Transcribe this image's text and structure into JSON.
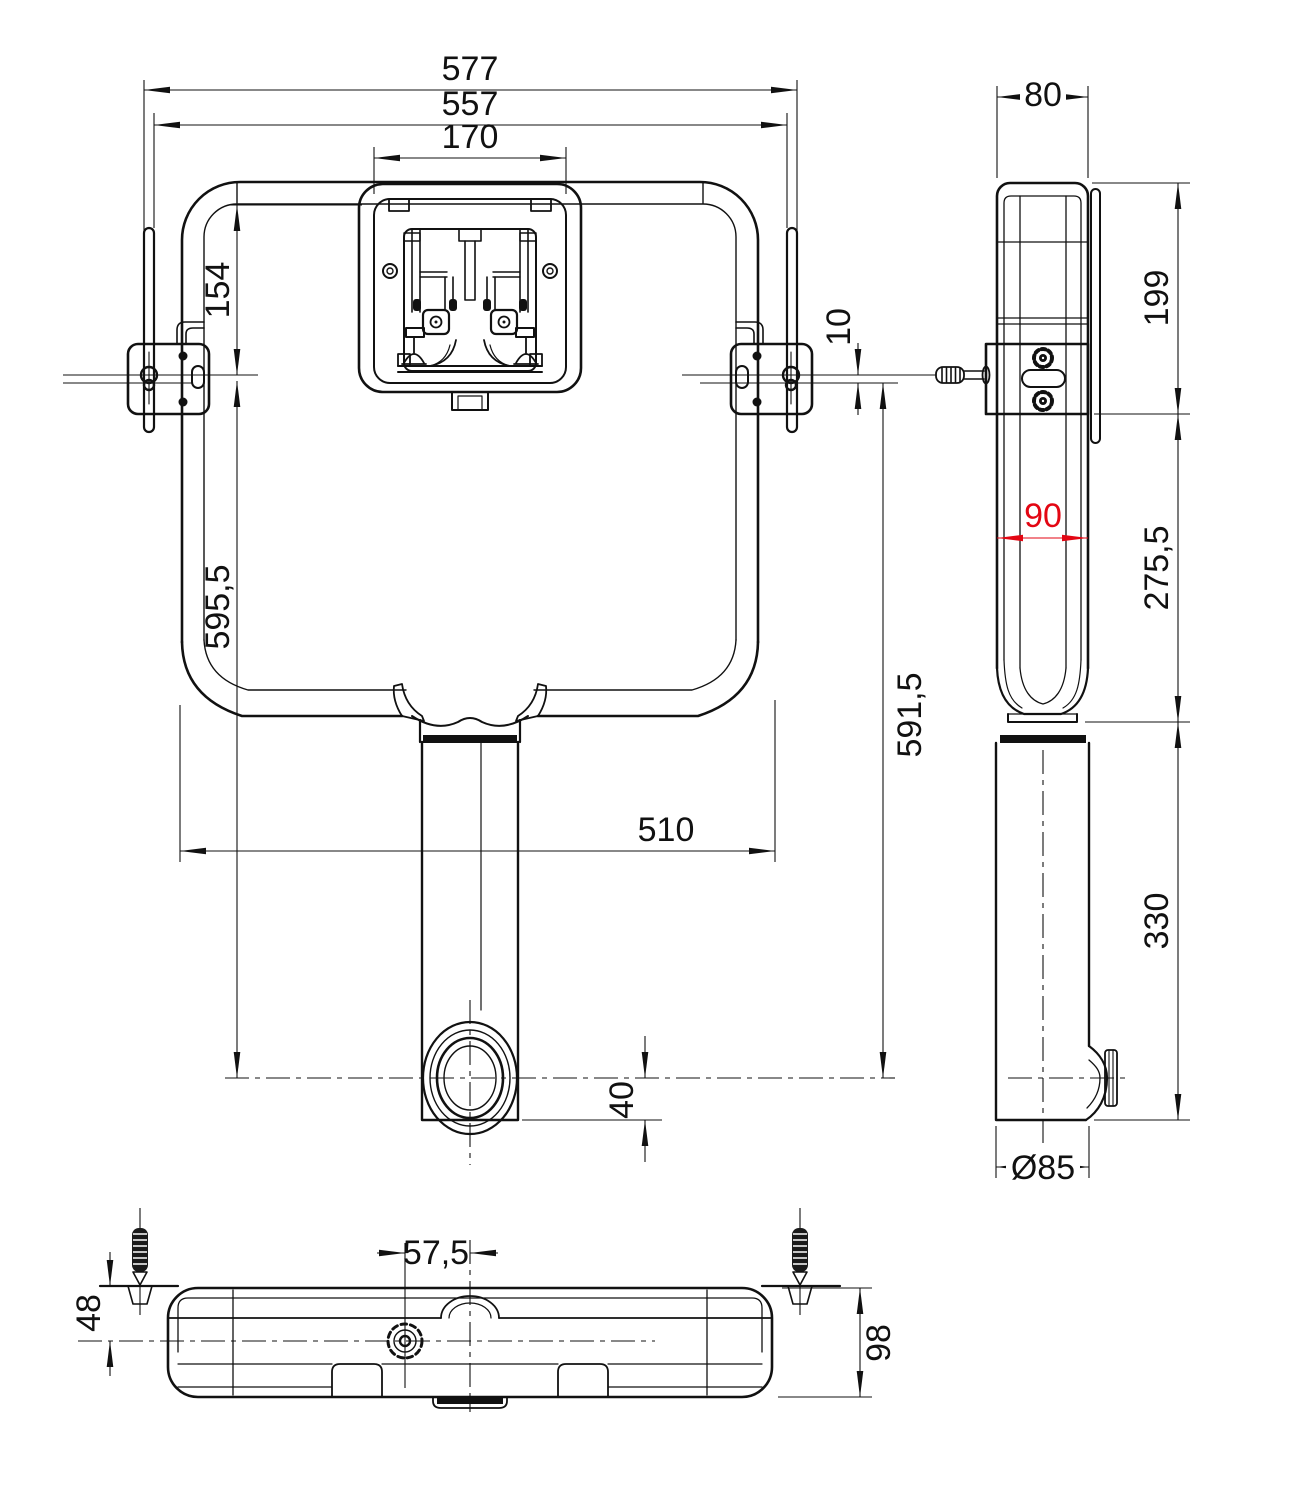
{
  "drawing": {
    "kind": "technical installation drawing",
    "subject": "concealed-cistern",
    "colors": {
      "line": "#111111",
      "highlight": "#e30613",
      "background": "#ffffff"
    },
    "views": {
      "front": {
        "dims": {
          "overall_width": "577",
          "body_width": "557",
          "panel_width": "170",
          "panel_height": "154",
          "axis_offset": "10",
          "height_left": "595,5",
          "height_right": "591,5",
          "base_width": "510",
          "outlet_drop": "40"
        }
      },
      "side": {
        "dims": {
          "depth": "80",
          "upper_height": "199",
          "recess_depth": "90",
          "mid_height": "275,5",
          "lower_height": "330",
          "outlet_diameter": "Ø85"
        }
      },
      "bottom": {
        "dims": {
          "inlet_offset": "57,5",
          "rear_offset": "48",
          "depth": "98"
        }
      }
    }
  }
}
